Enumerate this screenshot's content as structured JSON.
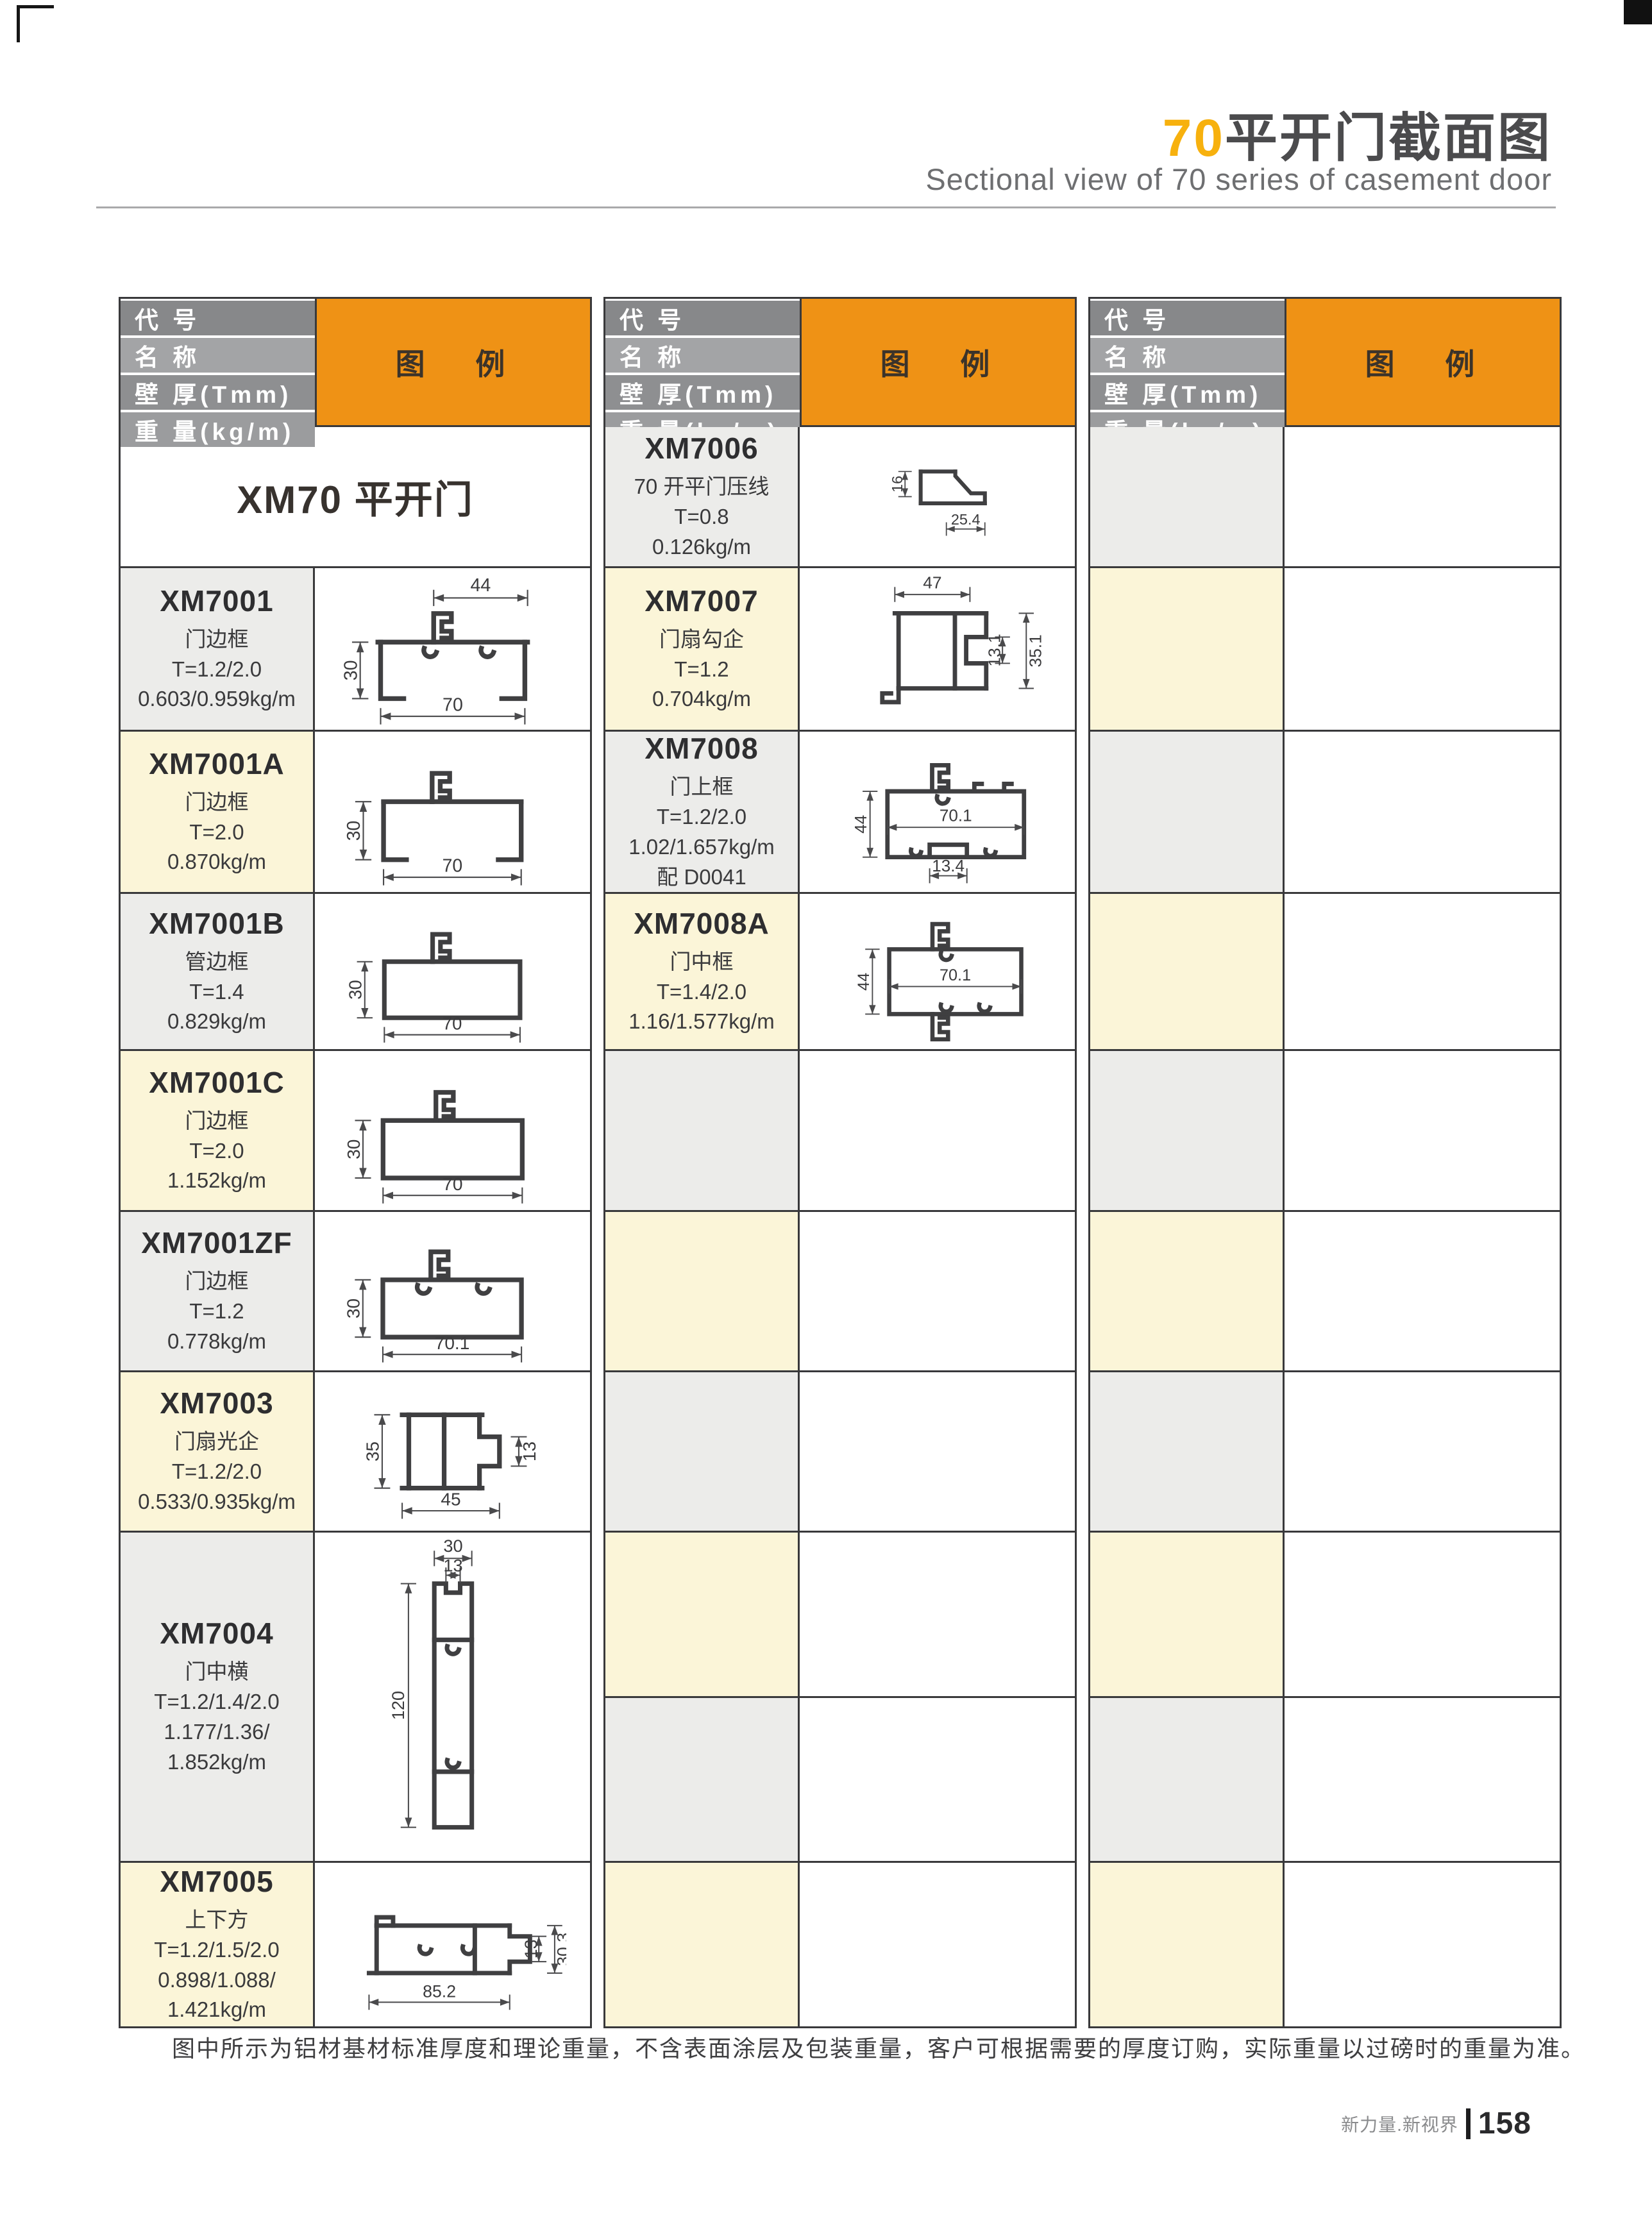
{
  "page": {
    "title_accent": "70",
    "title_rest": "平开门截面图",
    "subtitle": "Sectional  view of 70 series of casement door",
    "note": "图中所示为铝材基材标准厚度和理论重量，不含表面涂层及包装重量，客户可根据需要的厚度订购，实际重量以过磅时的重量为准。",
    "footer_brand": "新力量.新视界",
    "footer_page": "158"
  },
  "header": {
    "labels": [
      "代 号",
      "名 称",
      "壁 厚(Tmm)",
      "重 量(kg/m)"
    ],
    "legend": "图 例"
  },
  "series_banner": "XM70 平开门",
  "colors": {
    "title_accent": "#F7B10E",
    "legend_orange": "#EF9215",
    "row_gray": "#ECECEA",
    "row_cream": "#FBF5D8"
  },
  "tables": [
    {
      "rows": [
        {
          "type": "banner"
        },
        {
          "type": "profile",
          "tone": "gray",
          "code": "XM7001",
          "lines": [
            "门边框",
            "T=1.2/2.0",
            "0.603/0.959kg/m"
          ],
          "shape": "xm7001",
          "dims": [
            "44",
            "30",
            "70"
          ]
        },
        {
          "type": "profile",
          "tone": "cream",
          "code": "XM7001A",
          "lines": [
            "门边框",
            "T=2.0",
            "0.870kg/m"
          ],
          "shape": "xm7001a",
          "dims": [
            "30",
            "70"
          ]
        },
        {
          "type": "profile",
          "tone": "gray",
          "code": "XM7001B",
          "lines": [
            "管边框",
            "T=1.4",
            "0.829kg/m"
          ],
          "shape": "xm7001b",
          "dims": [
            "30",
            "70"
          ]
        },
        {
          "type": "profile",
          "tone": "cream",
          "code": "XM7001C",
          "lines": [
            "门边框",
            "T=2.0",
            "1.152kg/m"
          ],
          "shape": "xm7001c",
          "dims": [
            "30",
            "70"
          ]
        },
        {
          "type": "profile",
          "tone": "gray",
          "code": "XM7001ZF",
          "lines": [
            "门边框",
            "T=1.2",
            "0.778kg/m"
          ],
          "shape": "xm7001zf",
          "dims": [
            "30",
            "70.1"
          ]
        },
        {
          "type": "profile",
          "tone": "cream",
          "code": "XM7003",
          "lines": [
            "门扇光企",
            "T=1.2/2.0",
            "0.533/0.935kg/m"
          ],
          "shape": "xm7003",
          "dims": [
            "35",
            "13",
            "45"
          ]
        },
        {
          "type": "profile",
          "tone": "gray",
          "code": "XM7004",
          "lines": [
            "门中横",
            "T=1.2/1.4/2.0",
            "1.177/1.36/",
            "1.852kg/m"
          ],
          "shape": "xm7004",
          "dims": [
            "30",
            "13",
            "120"
          ]
        },
        {
          "type": "profile",
          "tone": "cream",
          "code": "XM7005",
          "lines": [
            "上下方",
            "T=1.2/1.5/2.0",
            "0.898/1.088/",
            "1.421kg/m"
          ],
          "shape": "xm7005",
          "dims": [
            "13",
            "30.3",
            "85.2"
          ]
        }
      ]
    },
    {
      "rows": [
        {
          "type": "profile",
          "tone": "gray",
          "code": "XM7006",
          "lines": [
            "70 开平门压线",
            "T=0.8",
            "0.126kg/m"
          ],
          "shape": "xm7006",
          "dims": [
            "16",
            "25.4"
          ]
        },
        {
          "type": "profile",
          "tone": "cream",
          "code": "XM7007",
          "lines": [
            "门扇勾企",
            "T=1.2",
            "0.704kg/m"
          ],
          "shape": "xm7007",
          "dims": [
            "47",
            "13.1",
            "35.1"
          ]
        },
        {
          "type": "profile",
          "tone": "gray",
          "code": "XM7008",
          "lines": [
            "门上框",
            "T=1.2/2.0",
            "1.02/1.657kg/m",
            "配 D0041"
          ],
          "shape": "xm7008",
          "dims": [
            "44",
            "70.1",
            "13.4"
          ]
        },
        {
          "type": "profile",
          "tone": "cream",
          "code": "XM7008A",
          "lines": [
            "门中框",
            "T=1.4/2.0",
            "1.16/1.577kg/m"
          ],
          "shape": "xm7008a",
          "dims": [
            "44",
            "70.1"
          ]
        },
        {
          "type": "empty",
          "tone": "gray"
        },
        {
          "type": "empty",
          "tone": "cream"
        },
        {
          "type": "empty",
          "tone": "gray"
        },
        {
          "type": "empty",
          "tone": "cream"
        },
        {
          "type": "empty",
          "tone": "gray"
        },
        {
          "type": "empty",
          "tone": "cream"
        }
      ]
    },
    {
      "rows": [
        {
          "type": "empty",
          "tone": "gray"
        },
        {
          "type": "empty",
          "tone": "cream"
        },
        {
          "type": "empty",
          "tone": "gray"
        },
        {
          "type": "empty",
          "tone": "cream"
        },
        {
          "type": "empty",
          "tone": "gray"
        },
        {
          "type": "empty",
          "tone": "cream"
        },
        {
          "type": "empty",
          "tone": "gray"
        },
        {
          "type": "empty",
          "tone": "cream"
        },
        {
          "type": "empty",
          "tone": "gray"
        },
        {
          "type": "empty",
          "tone": "cream"
        }
      ]
    }
  ]
}
